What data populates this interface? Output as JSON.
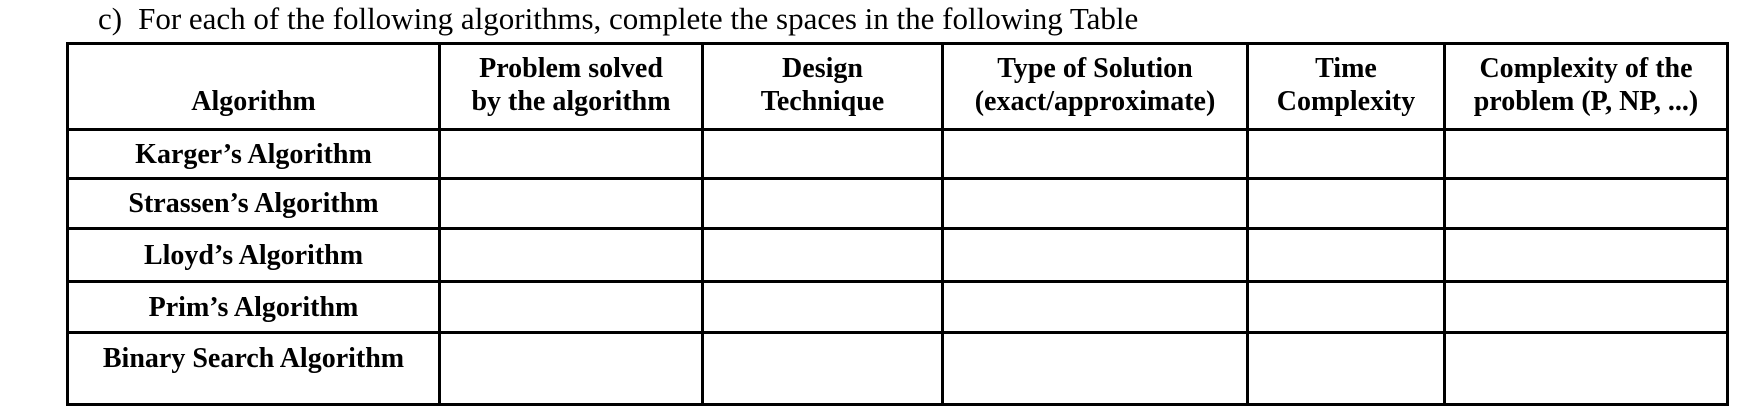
{
  "page": {
    "background": "#ffffff",
    "text_color": "#000000",
    "border_color": "#000000"
  },
  "heading": {
    "marker": "c)",
    "text": "For each of the following algorithms, complete the spaces in the following Table"
  },
  "table": {
    "header": {
      "algorithm": {
        "lines": [
          "Algorithm"
        ]
      },
      "problem": {
        "lines": [
          "Problem solved",
          "by the algorithm"
        ]
      },
      "design": {
        "lines": [
          "Design",
          "Technique"
        ]
      },
      "solution": {
        "lines": [
          "Type of Solution",
          "(exact/approximate)"
        ]
      },
      "time": {
        "lines": [
          "Time",
          "Complexity"
        ]
      },
      "complexity": {
        "lines": [
          "Complexity of the",
          "problem (P, NP, ...)"
        ]
      }
    },
    "rows": [
      {
        "algorithm": "Karger’s Algorithm"
      },
      {
        "algorithm": "Strassen’s Algorithm"
      },
      {
        "algorithm": "Lloyd’s Algorithm"
      },
      {
        "algorithm": "Prim’s Algorithm"
      },
      {
        "algorithm": "Binary Search Algorithm"
      }
    ]
  }
}
